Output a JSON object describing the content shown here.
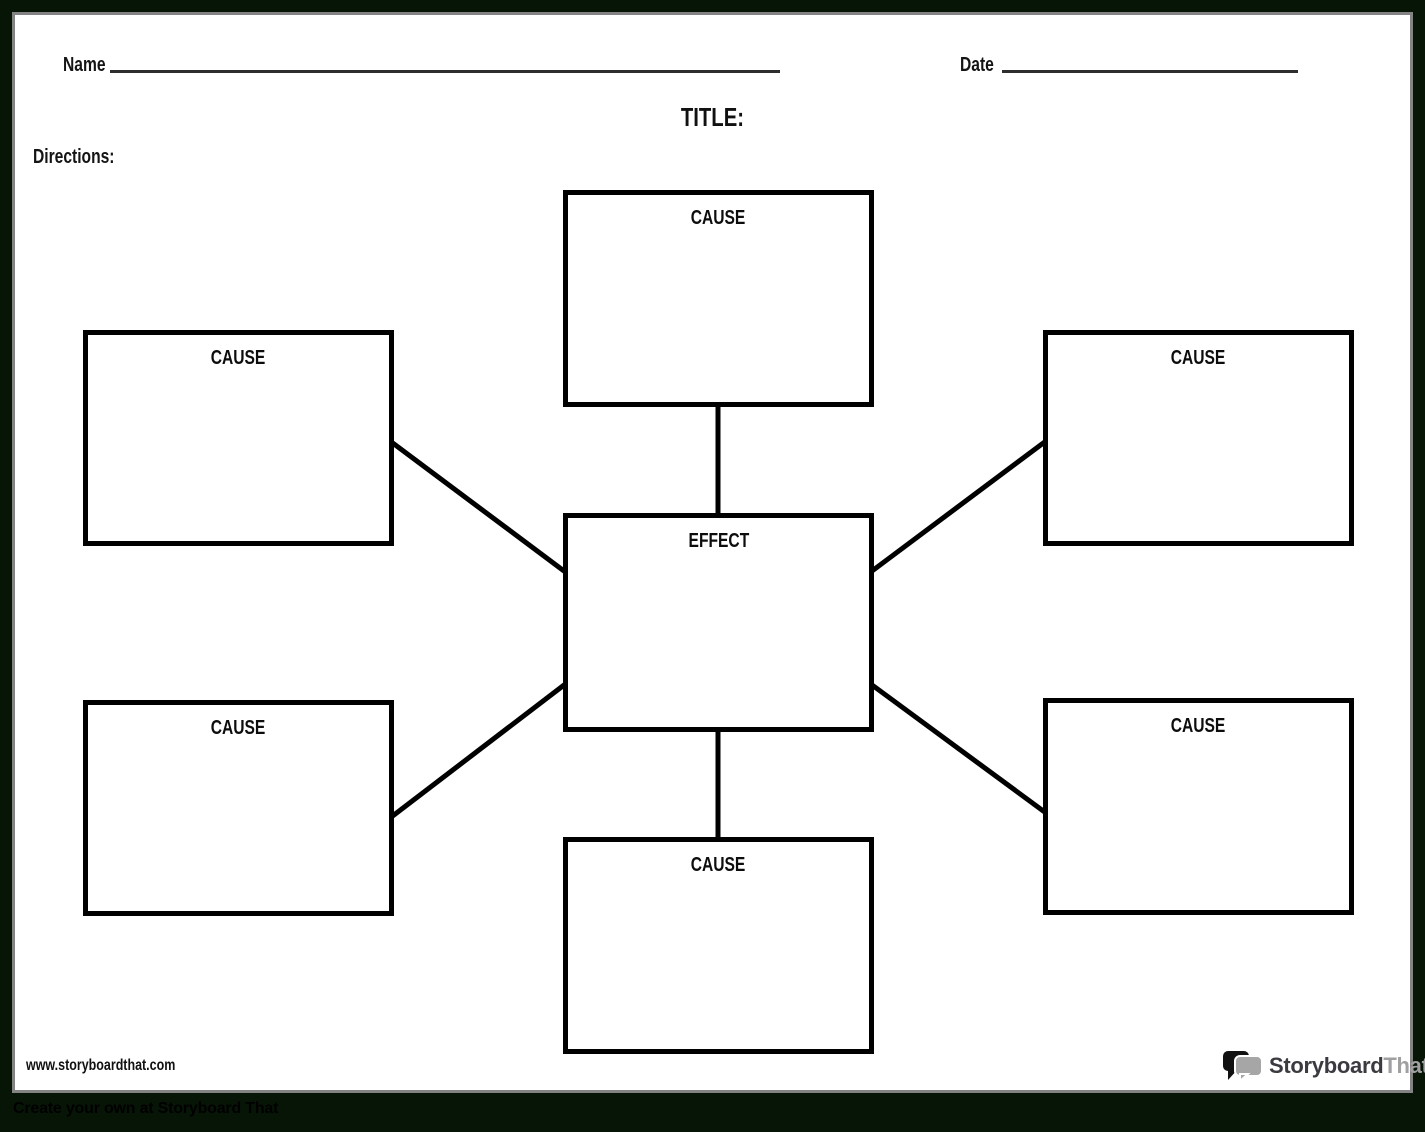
{
  "header": {
    "name_label": "Name",
    "date_label": "Date",
    "title": "TITLE:",
    "directions_label": "Directions:"
  },
  "diagram": {
    "type": "cause-effect-spider-map",
    "center": {
      "label": "EFFECT"
    },
    "causes": [
      {
        "position": "top",
        "label": "CAUSE"
      },
      {
        "position": "top-left",
        "label": "CAUSE"
      },
      {
        "position": "top-right",
        "label": "CAUSE"
      },
      {
        "position": "bottom-left",
        "label": "CAUSE"
      },
      {
        "position": "bottom-right",
        "label": "CAUSE"
      },
      {
        "position": "bottom",
        "label": "CAUSE"
      }
    ]
  },
  "footer": {
    "website": "www.storyboardthat.com",
    "brand": {
      "icon": "speech-bubbles-icon",
      "name_primary": "Storyboard",
      "name_secondary": "That"
    },
    "tagline": "Create your own at Storyboard That"
  },
  "colors": {
    "page_border_green": "#071507",
    "page_shadow_gray": "#838383",
    "line_black": "#000000",
    "brand_dark": "#3a3a40",
    "brand_gray": "#a0a0a3"
  }
}
